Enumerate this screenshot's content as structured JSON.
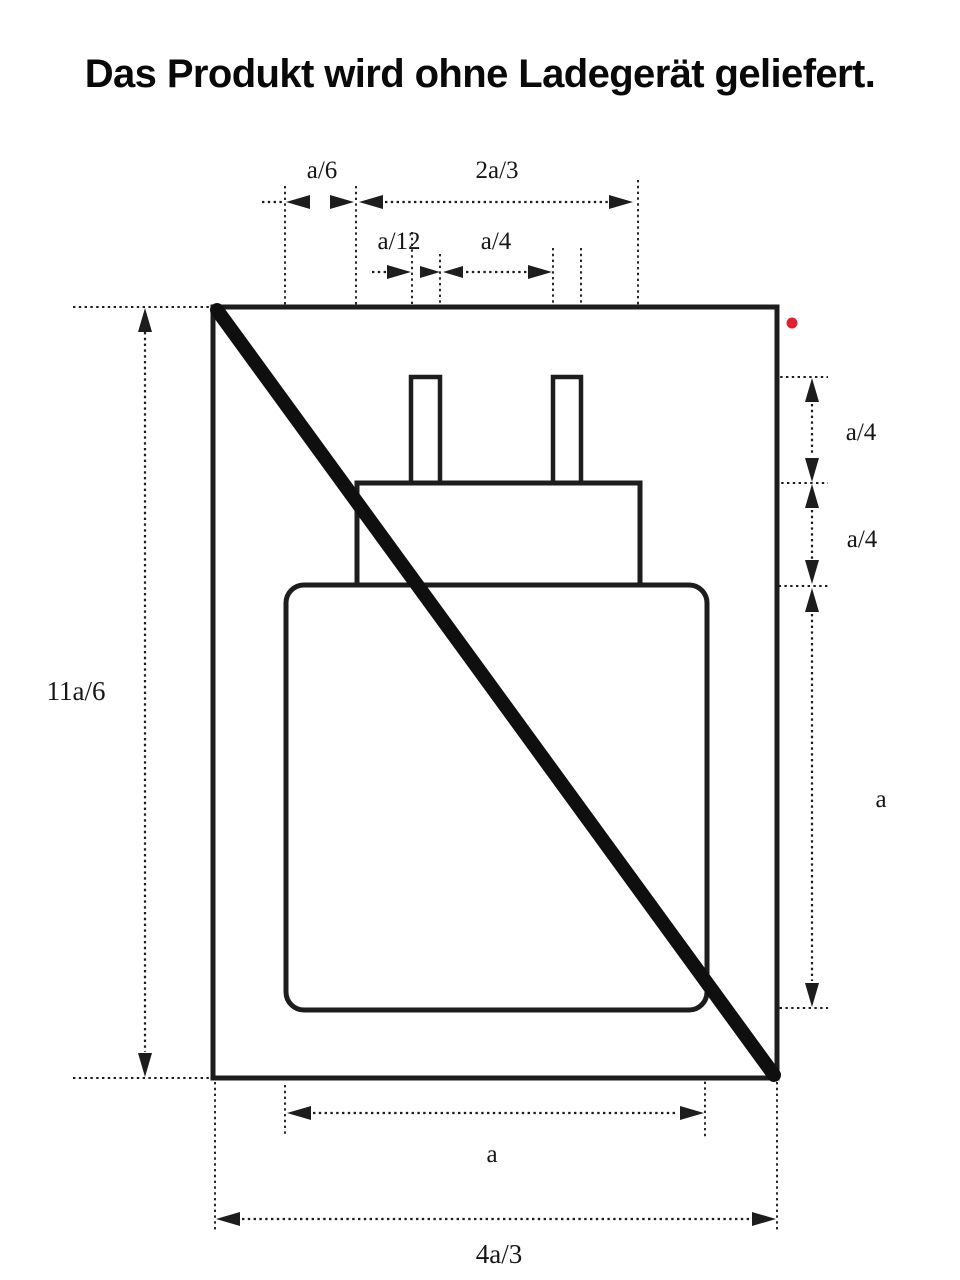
{
  "title": "Das Produkt wird ohne Ladegerät geliefert.",
  "figure": {
    "labels": {
      "a6": "a/6",
      "two_a3": "2a/3",
      "a12": "a/12",
      "a4_gap": "a/4",
      "a4_prong": "a/4",
      "a4_neck": "a/4",
      "a_right": "a",
      "eleven_a6": "11a/6",
      "a_bottom": "a",
      "four_a3": "4a/3"
    },
    "colors": {
      "line": "#1d1d1d",
      "strike": "#0f0f0f",
      "dot": "#e32030",
      "title_text": "#090909"
    }
  }
}
